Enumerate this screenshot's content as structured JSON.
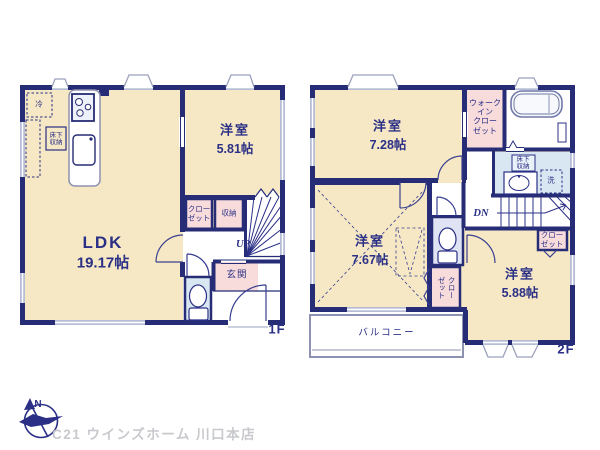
{
  "floor1": {
    "label": "1F",
    "ldk": {
      "name": "LDK",
      "area": "19.17帖"
    },
    "bedroom": {
      "name": "洋室",
      "area": "5.81帖"
    },
    "entrance": "玄関",
    "closet": "クロー\nゼット",
    "storage": "収納",
    "underfloor_storage": "床下\n収納",
    "refrigerator": "冷",
    "stairs_up": "UP"
  },
  "floor2": {
    "label": "2F",
    "bedroom1": {
      "name": "洋室",
      "area": "7.28帖"
    },
    "bedroom2": {
      "name": "洋室",
      "area": "7.67帖"
    },
    "bedroom3": {
      "name": "洋室",
      "area": "5.88帖"
    },
    "walk_in_closet": "ウォーク\nイン\nクロー\nゼット",
    "closet_bedroom3": "クロー\nゼット",
    "closet_bedroom2": "クローゼット",
    "underfloor_storage": "床下\n収納",
    "washer": "洗",
    "balcony": "バルコニー",
    "stairs_down": "DN"
  },
  "compass": {
    "north_label": "N"
  },
  "watermark": "C21 ウインズホーム 川口本店",
  "colors": {
    "wall": "#262c75",
    "text": "#2b3086",
    "room_cream": "#f6e8c5",
    "closet_pink": "#f8dcdc",
    "wet_area_blue": "#d9e7f2",
    "toilet_lavender": "#dfe3f3",
    "window": "#b7bdd6",
    "watermark_gray": "#c8c9cd"
  }
}
